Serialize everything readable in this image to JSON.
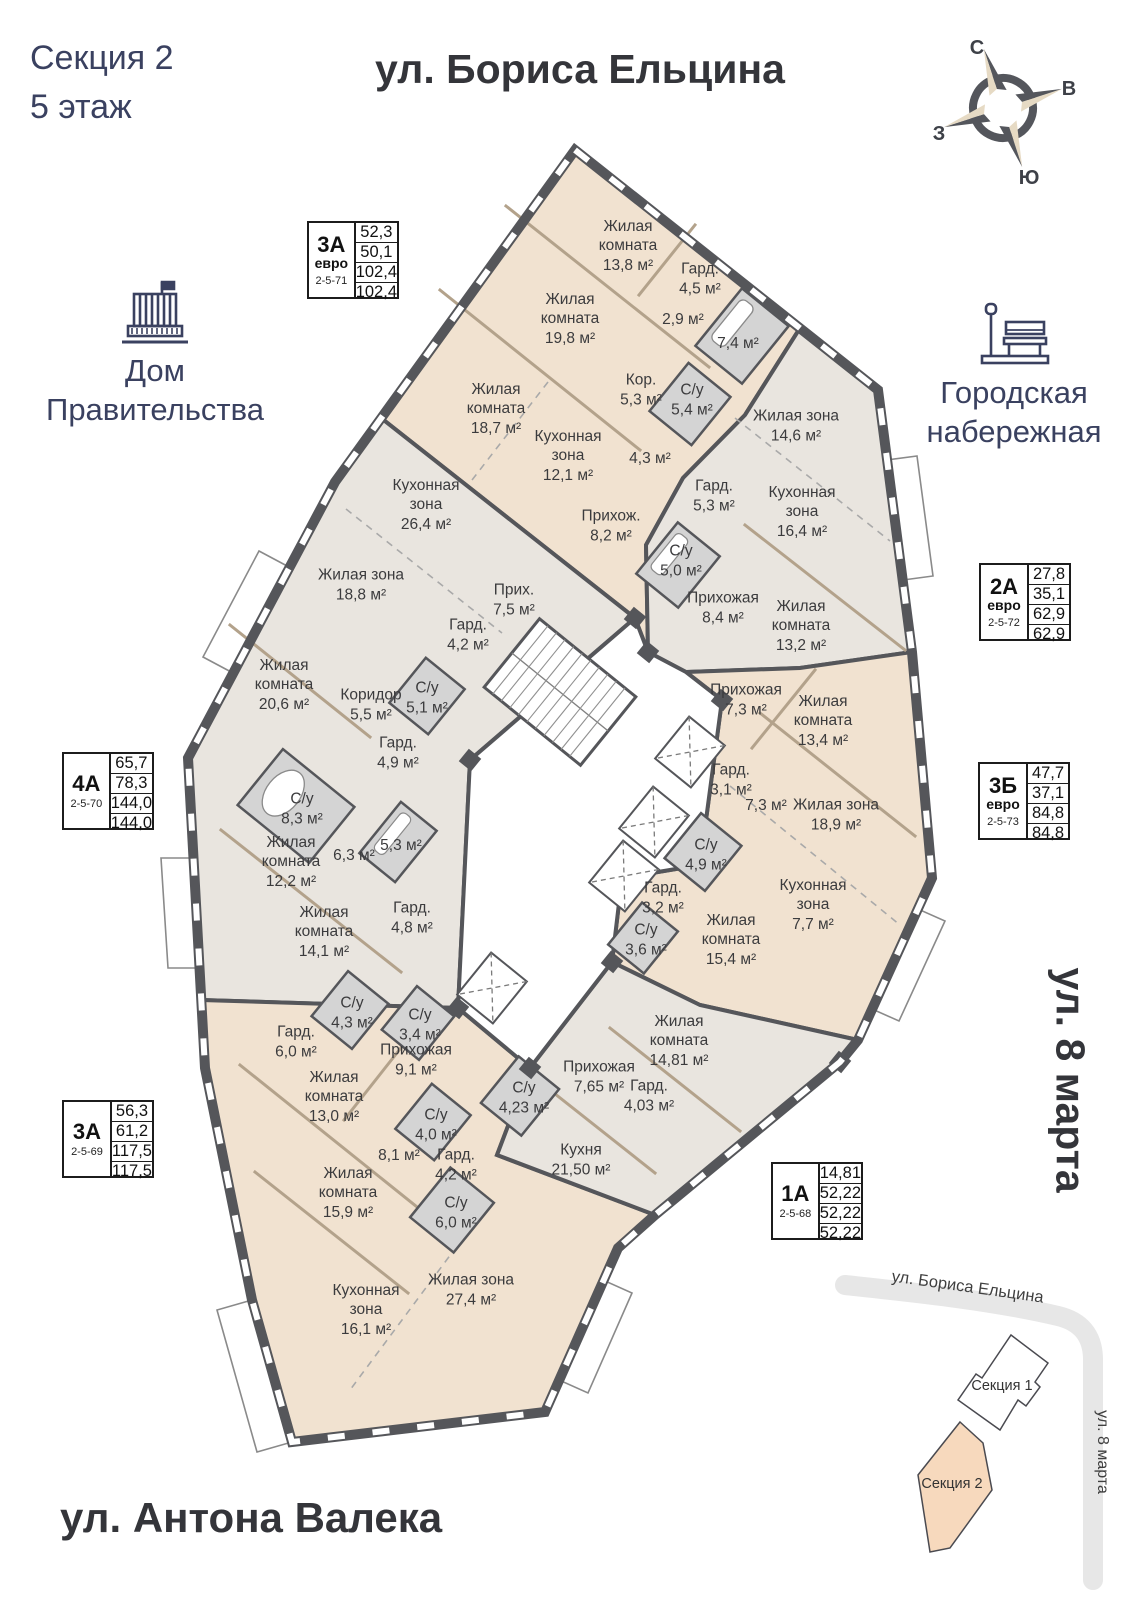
{
  "header": {
    "section": "Секция 2",
    "floor": "5 этаж",
    "street_top": "ул. Бориса Ельцина",
    "street_bottom": "ул. Антона Валека",
    "street_right": "ул. 8 марта"
  },
  "landmarks": {
    "government": "Дом Правительства",
    "embankment": "Городская набережная"
  },
  "compass": {
    "n": "С",
    "e": "В",
    "s": "Ю",
    "w": "З"
  },
  "apartments": [
    {
      "type": "3А",
      "euro": "евро",
      "code": "2-5-71",
      "values": [
        "52,3",
        "50,1",
        "102,4",
        "102,4"
      ]
    },
    {
      "type": "2А",
      "euro": "евро",
      "code": "2-5-72",
      "values": [
        "27,8",
        "35,1",
        "62,9",
        "62,9"
      ]
    },
    {
      "type": "3Б",
      "euro": "евро",
      "code": "2-5-73",
      "values": [
        "47,7",
        "37,1",
        "84,8",
        "84,8"
      ]
    },
    {
      "type": "4А",
      "euro": "",
      "code": "2-5-70",
      "values": [
        "65,7",
        "78,3",
        "144,0",
        "144,0"
      ]
    },
    {
      "type": "3А",
      "euro": "",
      "code": "2-5-69",
      "values": [
        "56,3",
        "61,2",
        "117,5",
        "117,5"
      ]
    },
    {
      "type": "1А",
      "euro": "",
      "code": "2-5-68",
      "values": [
        "14,81",
        "52,22",
        "52,22",
        "52,22"
      ]
    }
  ],
  "rooms": [
    {
      "name": "Жилая комната",
      "area": "13,8 м²"
    },
    {
      "name": "Гард.",
      "area": "4,5 м²"
    },
    {
      "name": "",
      "area": "2,9 м²"
    },
    {
      "name": "",
      "area": "7,4 м²"
    },
    {
      "name": "Жилая комната",
      "area": "19,8 м²"
    },
    {
      "name": "Жилая комната",
      "area": "18,7 м²"
    },
    {
      "name": "Кухонная зона",
      "area": "12,1 м²"
    },
    {
      "name": "Кор.",
      "area": "5,3 м²"
    },
    {
      "name": "С/у",
      "area": "5,4 м²"
    },
    {
      "name": "",
      "area": "4,3 м²"
    },
    {
      "name": "Прихож.",
      "area": "8,2 м²"
    },
    {
      "name": "Жилая зона",
      "area": "14,6 м²"
    },
    {
      "name": "Кухонная зона",
      "area": "16,4 м²"
    },
    {
      "name": "Гард.",
      "area": "5,3 м²"
    },
    {
      "name": "С/у",
      "area": "5,0 м²"
    },
    {
      "name": "Прихожая",
      "area": "8,4 м²"
    },
    {
      "name": "Жилая комната",
      "area": "13,2 м²"
    },
    {
      "name": "Кухонная зона",
      "area": "26,4 м²"
    },
    {
      "name": "Жилая зона",
      "area": "18,8 м²"
    },
    {
      "name": "Прих.",
      "area": "7,5 м²"
    },
    {
      "name": "Гард.",
      "area": "4,2 м²"
    },
    {
      "name": "Жилая комната",
      "area": "20,6 м²"
    },
    {
      "name": "Коридор",
      "area": "5,5 м²"
    },
    {
      "name": "С/у",
      "area": "5,1 м²"
    },
    {
      "name": "Гард.",
      "area": "4,9 м²"
    },
    {
      "name": "С/у",
      "area": "8,3 м²"
    },
    {
      "name": "Жилая комната",
      "area": "12,2 м²"
    },
    {
      "name": "",
      "area": "6,3 м²"
    },
    {
      "name": "",
      "area": "5,3 м²"
    },
    {
      "name": "Жилая комната",
      "area": "14,1 м²"
    },
    {
      "name": "Гард.",
      "area": "4,8 м²"
    },
    {
      "name": "Прихожая",
      "area": "7,3 м²"
    },
    {
      "name": "Жилая комната",
      "area": "13,4 м²"
    },
    {
      "name": "Гард.",
      "area": "3,1 м²"
    },
    {
      "name": "",
      "area": "7,3 м²"
    },
    {
      "name": "Жилая зона",
      "area": "18,9 м²"
    },
    {
      "name": "С/у",
      "area": "4,9 м²"
    },
    {
      "name": "Кухонная зона",
      "area": "7,7 м²"
    },
    {
      "name": "Гард.",
      "area": "3,2 м²"
    },
    {
      "name": "С/у",
      "area": "3,6 м²"
    },
    {
      "name": "Жилая комната",
      "area": "15,4 м²"
    },
    {
      "name": "Гард.",
      "area": "6,0 м²"
    },
    {
      "name": "С/у",
      "area": "4,3 м²"
    },
    {
      "name": "С/у",
      "area": "3,4 м²"
    },
    {
      "name": "Прихожая",
      "area": "9,1 м²"
    },
    {
      "name": "Жилая комната",
      "area": "13,0 м²"
    },
    {
      "name": "С/у",
      "area": "4,0 м²"
    },
    {
      "name": "",
      "area": "8,1 м²"
    },
    {
      "name": "Гард.",
      "area": "4,2 м²"
    },
    {
      "name": "Жилая комната",
      "area": "15,9 м²"
    },
    {
      "name": "С/у",
      "area": "6,0 м²"
    },
    {
      "name": "Кухонная зона",
      "area": "16,1 м²"
    },
    {
      "name": "Жилая зона",
      "area": "27,4 м²"
    },
    {
      "name": "Жилая комната",
      "area": "14,81 м²"
    },
    {
      "name": "Прихожая",
      "area": "7,65 м²"
    },
    {
      "name": "Гард.",
      "area": "4,03 м²"
    },
    {
      "name": "С/у",
      "area": "4,23 м²"
    },
    {
      "name": "Кухня",
      "area": "21,50 м²"
    }
  ],
  "minimap": {
    "section1": "Секция 1",
    "section2": "Секция 2",
    "street_top": "ул. Бориса Ельцина",
    "street_right": "ул. 8 марта"
  },
  "colors": {
    "apartment_warm": "#f1e2d0",
    "apartment_cool": "#e9e5df",
    "bathroom": "#d4d4d4",
    "wall": "#55565a",
    "accent_navy": "#3a4160",
    "street_text": "#34353a",
    "partition": "#b3a28b",
    "road": "#e7e7e7",
    "minimap_building": "#f7d9bd",
    "compass_beige": "#e6dac4"
  }
}
